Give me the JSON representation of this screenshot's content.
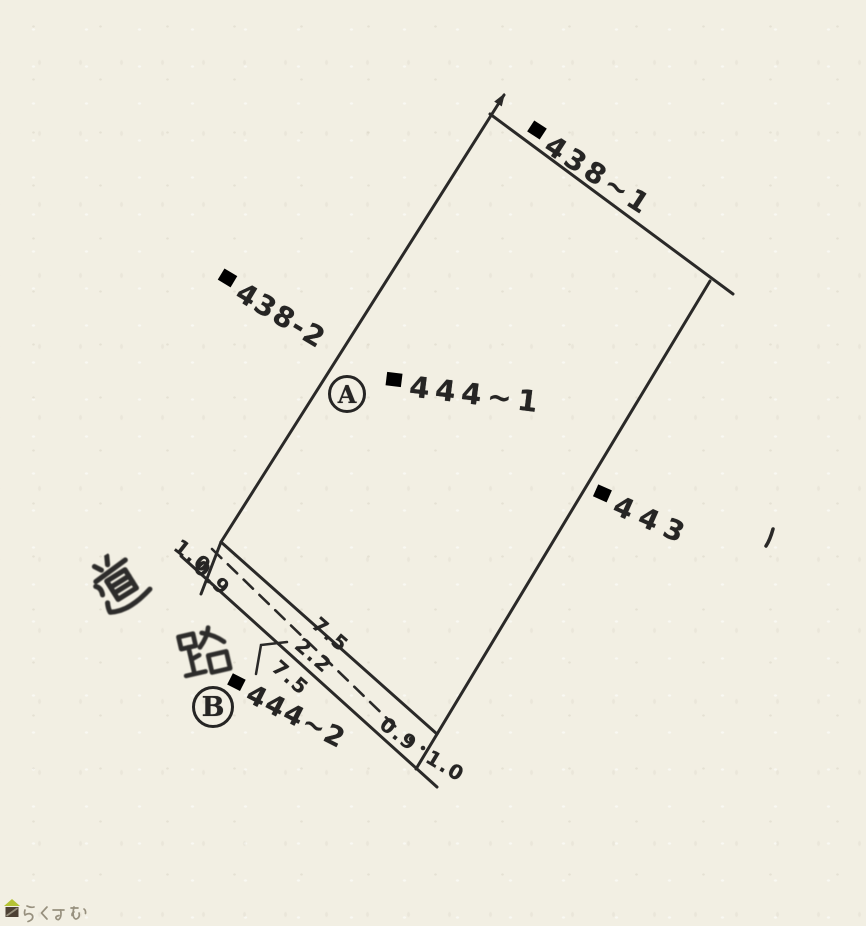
{
  "colors": {
    "paper": "#f2efe3",
    "ink": "#262524",
    "wm-text": "#97907e",
    "wm-roof": "#b4c335",
    "wm-body": "#4c4034"
  },
  "parcel_labels": {
    "north": {
      "kanji_prefix": "甲",
      "number": "438~1"
    },
    "west": {
      "kanji_prefix": "甲",
      "number": "438-2"
    },
    "center": {
      "point_letter": "A",
      "kanji_prefix": "甲",
      "number": "444~1"
    },
    "east": {
      "kanji_prefix": "甲",
      "number": "443"
    },
    "south": {
      "point_letter": "B",
      "kanji_prefix": "甲",
      "number": "444~2"
    }
  },
  "road": {
    "label": "道路",
    "label_char_top": "道",
    "label_char_bottom": "路"
  },
  "measurements": {
    "west_outer": "1.0",
    "west_inner": "0.9",
    "frontage_upper": "7.5",
    "road_width": "2.2",
    "frontage_lower": "7.5",
    "east_inner": "0.9",
    "east_outer": "1.0"
  },
  "watermark": {
    "text": "らくすむ"
  }
}
